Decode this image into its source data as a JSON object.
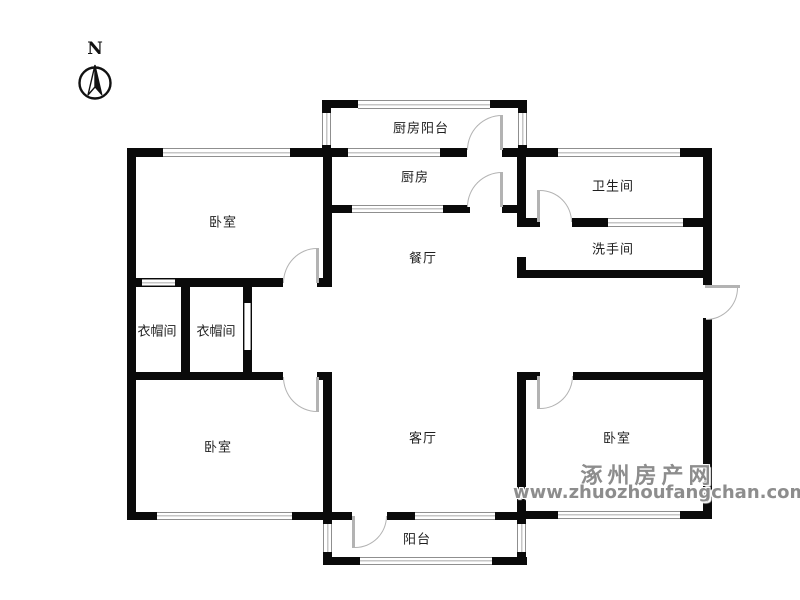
{
  "plan": {
    "compass_letter": "N",
    "rooms": [
      {
        "id": "kitchen-balcony",
        "label": "厨房阳台"
      },
      {
        "id": "kitchen",
        "label": "厨房"
      },
      {
        "id": "bathroom",
        "label": "卫生间"
      },
      {
        "id": "washroom",
        "label": "洗手间"
      },
      {
        "id": "bedroom-top-left",
        "label": "卧室"
      },
      {
        "id": "dining-room",
        "label": "餐厅"
      },
      {
        "id": "cloakroom-left",
        "label": "衣帽间"
      },
      {
        "id": "cloakroom-right",
        "label": "衣帽间"
      },
      {
        "id": "bedroom-bottom-left",
        "label": "卧室"
      },
      {
        "id": "living-room",
        "label": "客厅"
      },
      {
        "id": "bedroom-bottom-right",
        "label": "卧室"
      },
      {
        "id": "balcony",
        "label": "阳台"
      }
    ],
    "watermark": {
      "site_name": "涿州房产网",
      "url": "www.zhuozhoufangchan.com"
    },
    "colors": {
      "wall": "#0a0a0a",
      "window_frame": "#8f8f8f",
      "door_arc": "#b3b3b3",
      "watermark_text": "#8d8d8d"
    }
  }
}
